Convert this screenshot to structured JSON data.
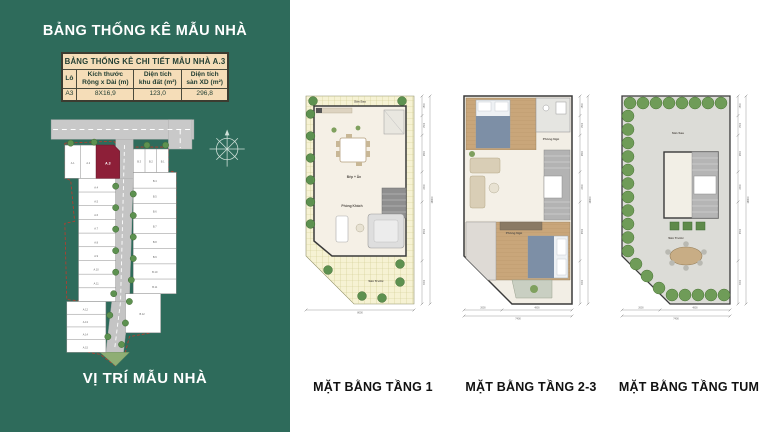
{
  "colors": {
    "sidebar_green": "#2e6b5b",
    "table_bg": "#f5ddb8",
    "highlight_lot": "#8d1f38",
    "caption_text": "#111111",
    "tree_green": "#5d9150",
    "road_grey": "#c9c9c9"
  },
  "sidebar": {
    "title": "BẢNG THỐNG KÊ MẪU NHÀ",
    "caption": "VỊ TRÍ MẪU NHÀ",
    "table": {
      "title": "BẢNG THỐNG KÊ CHI TIẾT MẪU NHÀ A.3",
      "columns": [
        "Lô",
        "Kích thước\nRộng x Dài (m)",
        "Diện tích\nkhu đất (m²)",
        "Diện tích\nsàn XD (m²)"
      ],
      "rows": [
        [
          "A3",
          "8X16,9",
          "123,0",
          "296,8"
        ]
      ]
    },
    "siteplan": {
      "highlight_lot": "A.3",
      "a_lots": [
        "A.1",
        "A.2",
        "A.3",
        "A.4",
        "A.5",
        "A.6",
        "A.7",
        "A.8",
        "A.9",
        "A.10",
        "A.11",
        "A.12",
        "A.13",
        "A.14",
        "A.15"
      ],
      "b_lots": [
        "B.1",
        "B.2",
        "B.3",
        "B.4",
        "B.5",
        "B.6",
        "B.7",
        "B.8",
        "B.9",
        "B.10",
        "B.11",
        "B.12"
      ]
    }
  },
  "plans": [
    {
      "caption": "MẶT BẰNG TẦNG 1",
      "rooms": [
        "Sân Sau",
        "Bếp + Ăn",
        "Phòng Khách",
        "Sân Trước"
      ],
      "dims": {
        "side_segments": [
          "1500",
          "1500",
          "2800",
          "2300",
          "4500",
          "3300"
        ],
        "side_total": "16900",
        "bottom_segments": [],
        "bottom_total": "8000"
      }
    },
    {
      "caption": "MẶT BẰNG TẦNG 2-3",
      "rooms": [
        "Phòng Ngủ",
        "Phòng Ngủ"
      ],
      "dims": {
        "side_segments": [
          "1500",
          "1500",
          "2800",
          "2300",
          "4500",
          "3300"
        ],
        "side_total": "16900",
        "bottom_segments": [
          "2600",
          "4800"
        ],
        "bottom_total": "7400"
      }
    },
    {
      "caption": "MẶT BẰNG TẦNG TUM",
      "rooms": [
        "Sân Sau",
        "Sân Trước"
      ],
      "dims": {
        "side_segments": [
          "1500",
          "1500",
          "2800",
          "2300",
          "4500",
          "3300"
        ],
        "side_total": "16900",
        "bottom_segments": [
          "2600",
          "4800"
        ],
        "bottom_total": "7400"
      }
    }
  ]
}
